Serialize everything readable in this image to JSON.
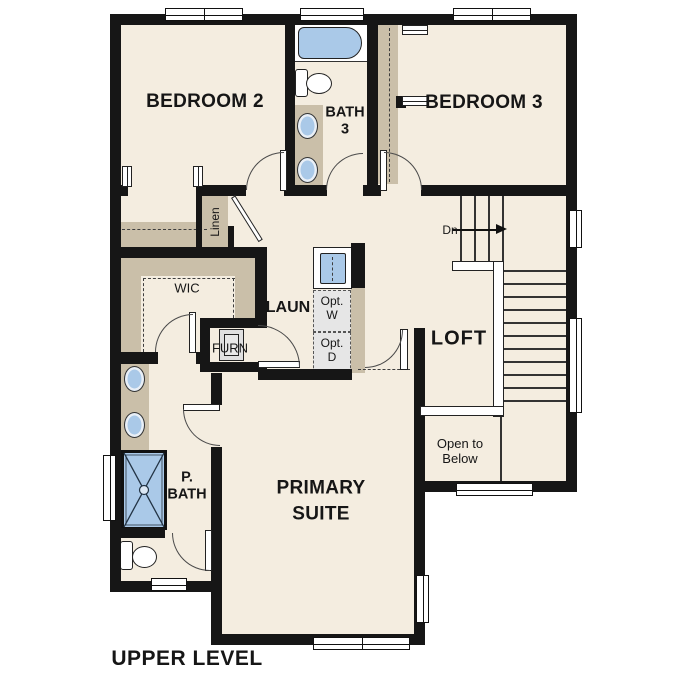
{
  "plan_title": "UPPER LEVEL",
  "colors": {
    "floor": "#f4ede0",
    "wall": "#161616",
    "cabinet": "#cabfa9",
    "fixture": "#aac9e8",
    "appliance": "#e6e6e6"
  },
  "rooms": {
    "bedroom2": "BEDROOM 2",
    "bath3": "BATH\n3",
    "bedroom3": "BEDROOM 3",
    "linen": "Linen",
    "wic": "WIC",
    "laundry": "LAUN",
    "opt_washer": "Opt.\nW",
    "opt_dryer": "Opt.\nD",
    "furnace": "FURN",
    "loft": "LOFT",
    "primary_bath": "P.\nBATH",
    "primary_suite": "PRIMARY\nSUITE",
    "open_to_below": "Open to\nBelow"
  },
  "stairs": {
    "down_label": "Dn"
  }
}
